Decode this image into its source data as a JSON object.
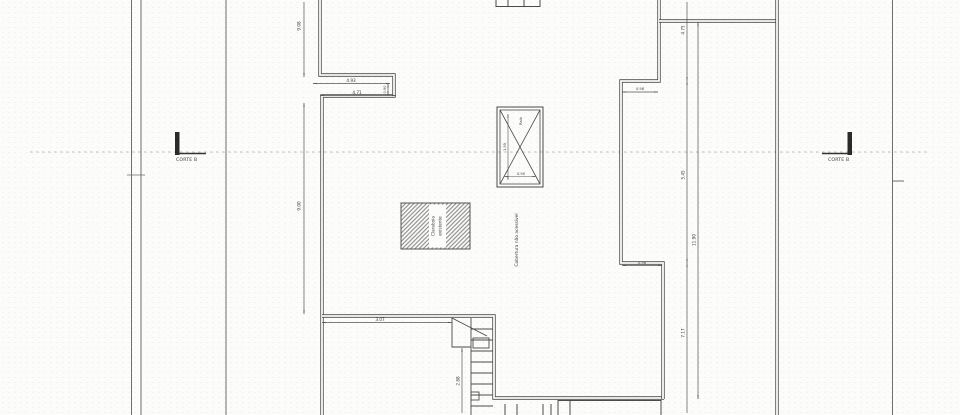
{
  "section_markers": {
    "left_label": "CORTE B",
    "right_label": "CORTE B"
  },
  "annotations": {
    "roof_note": "Cobertura não acessível",
    "hatch_label_line1": "Claraboia",
    "hatch_label_line2": "existente",
    "shaft_label": "Ralo"
  },
  "dimensions": {
    "left_top_v": "9.08",
    "left_bottom_v": "9.00",
    "notch_top_h": "4.93",
    "notch_bottom_h": "4.71",
    "notch_right_v": "0.90",
    "right_seg_top": "4.75",
    "right_seg_mid": "5.45",
    "right_seg_bottom": "7.17",
    "right_total": "11.90",
    "step_top_h": "0.98",
    "step_bottom_h": "0.98",
    "wing_bottom_h": "3.07",
    "stair_v": "2.88",
    "shaft_v": "1.95",
    "shaft_h": "0.90"
  },
  "colors": {
    "paper": "#fcfcfa",
    "ink": "#4a4a4a",
    "dim_line": "#555555",
    "dash_line": "#a8a8a8"
  }
}
